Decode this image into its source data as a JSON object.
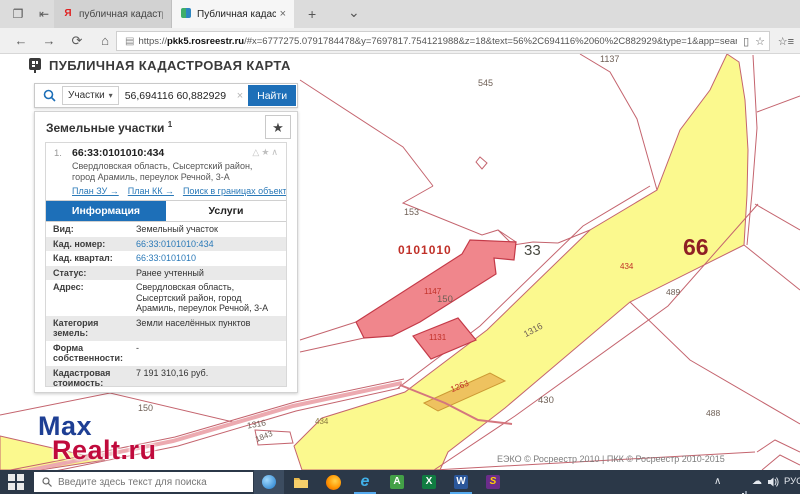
{
  "browser": {
    "tabs": [
      {
        "label": "публичная кадастровая ка",
        "favicon": "Я"
      },
      {
        "label": "Публичная кадастрова",
        "close": "×"
      }
    ],
    "new_tab_glyph": "+",
    "tab_menu_glyph": "⌄",
    "preview_glyph": "❐",
    "setaside_glyph": "⇤",
    "nav": {
      "back": "←",
      "forward": "→",
      "refresh": "⟳",
      "home": "⌂"
    },
    "url": {
      "prefix": "https://",
      "domain": "pkk5.rosreestr.ru",
      "rest": "/#x=6777275.0791784478&y=7697817.754121988&z=18&text=56%2C694116%2060%2C882929&type=1&app=search&opened=1"
    },
    "icons": {
      "page": "▤",
      "reading": "▯",
      "favorite": "☆",
      "favbar": "☆≡"
    }
  },
  "site": {
    "title": "ПУБЛИЧНАЯ КАДАСТРОВАЯ КАРТА",
    "search": {
      "category": "Участки",
      "caret": "▾",
      "value": "56,694116 60,882929",
      "clear_glyph": "×",
      "button": "Найти"
    },
    "panel": {
      "title": "Земельные участки",
      "count": "1",
      "star_glyph": "★",
      "item": {
        "index": "1.",
        "cadastral_number": "66:33:0101010:434",
        "address": "Свердловская область, Сысертский район, город Арамиль, переулок Речной, 3-А",
        "controls": "△★∧",
        "links": [
          "План ЗУ →",
          "План КК →",
          "Поиск в границах объекта →"
        ],
        "tabs": [
          "Информация",
          "Услуги"
        ],
        "fields": [
          {
            "label": "Вид:",
            "value": "Земельный участок"
          },
          {
            "label": "Кад. номер:",
            "value": "66:33:0101010:434"
          },
          {
            "label": "Кад. квартал:",
            "value": "66:33:0101010"
          },
          {
            "label": "Статус:",
            "value": "Ранее учтенный"
          },
          {
            "label": "Адрес:",
            "value": "Свердловская область, Сысертский район, город Арамиль, переулок Речной, 3-А"
          },
          {
            "label": "Категория земель:",
            "value": "Земли населённых пунктов"
          },
          {
            "label": "Форма собственности:",
            "value": "-"
          },
          {
            "label": "Кадастровая стоимость:",
            "value": "7 191 310,16 руб."
          },
          {
            "label": "Уточненная площадь:",
            "value": "6 911 кв. м"
          },
          {
            "label": "Разрешенное использование:",
            "value": "Для размещения производственных зданий"
          },
          {
            "label": "по документу:",
            "value": "под строительство объектов промышленности (производственная база)"
          }
        ]
      }
    },
    "attribution": "ЕЭКО © Росреестр 2010 | ПКК © Росреестр 2010-2015"
  },
  "map": {
    "labels": [
      {
        "text": "1137"
      },
      {
        "text": "545"
      },
      {
        "text": "153"
      },
      {
        "text": "0101010"
      },
      {
        "text": "33"
      },
      {
        "text": "66"
      },
      {
        "text": "434"
      },
      {
        "text": "489"
      },
      {
        "text": "1147"
      },
      {
        "text": "150"
      },
      {
        "text": "1131"
      },
      {
        "text": "1316"
      },
      {
        "text": "430"
      },
      {
        "text": "488"
      },
      {
        "text": "434"
      },
      {
        "text": "150"
      },
      {
        "text": "1316"
      },
      {
        "text": "1843"
      },
      {
        "text": "1263"
      }
    ],
    "colors": {
      "parcel_yellow": "#fbf98e",
      "parcel_selected": "#f0868c",
      "line": "#c4646e",
      "strip_orange": "#eec25f"
    }
  },
  "watermark": {
    "line1": "Max",
    "line2": "Realt.ru"
  },
  "taskbar": {
    "search_placeholder": "Введите здесь текст для поиска",
    "language": "РУС"
  },
  "colors": {
    "accent_blue": "#1d6fb8",
    "link_blue": "#2a79b8",
    "taskbar_bg": "#2b3848",
    "label_red": "#c03028"
  }
}
